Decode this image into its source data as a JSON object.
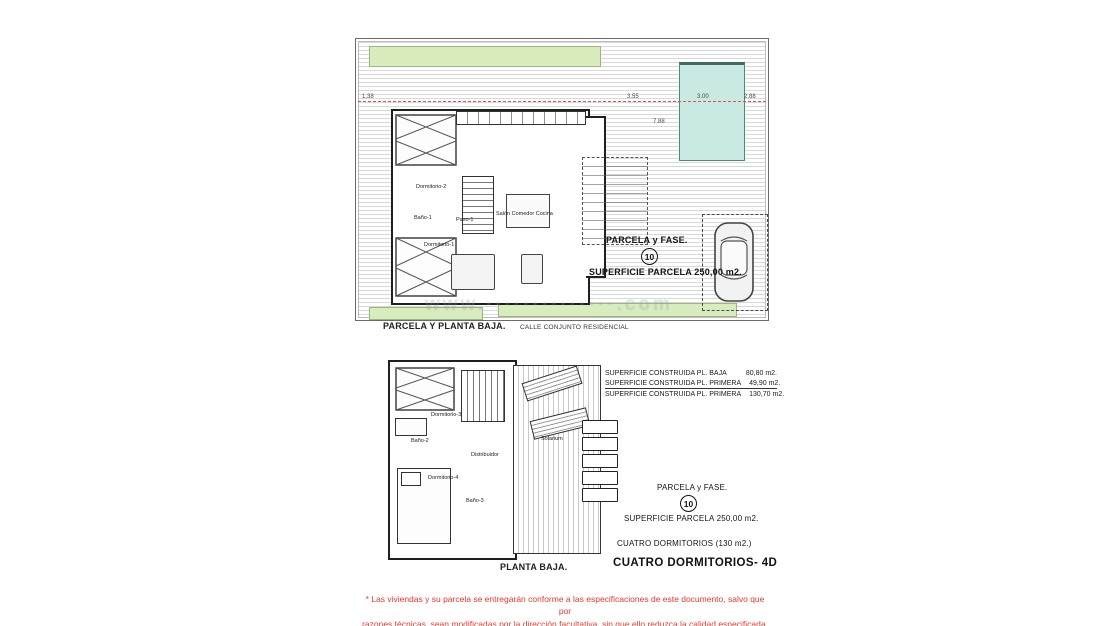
{
  "watermark": "www.··············.com",
  "site_plan": {
    "caption": "PARCELA Y PLANTA BAJA.",
    "street": "CALLE CONJUNTO RESIDENCIAL",
    "parcel_label": "PARCELA y FASE.",
    "parcel_number": "10",
    "parcel_area": "SUPERFICIE PARCELA 250,00 m2.",
    "rooms": {
      "bedroom2": "Dormitorio-2",
      "bath1": "Baño-1",
      "hall": "Paso-1",
      "bedroom1": "Dormitorio-1",
      "living": "Salón Comedor Cocina"
    },
    "dimensions": {
      "left": "1.38",
      "d1": "3.55",
      "d2": "3.00",
      "d3": "2.88",
      "d4": "7.88"
    }
  },
  "floor_plan": {
    "caption": "PLANTA BAJA.",
    "rooms": {
      "bedroom3": "Dormitorio-3",
      "bath2": "Baño-2",
      "hall": "Distribuidor",
      "bedroom4": "Dormitorio-4",
      "bath3": "Baño-3",
      "solarium": "Solarium"
    }
  },
  "summary": {
    "areas": [
      {
        "label": "SUPERFICIE CONSTRUIDA PL. BAJA",
        "value": "80,80 m2."
      },
      {
        "label": "SUPERFICIE CONSTRUIDA PL. PRIMERA",
        "value": "49,90 m2."
      },
      {
        "label": "SUPERFICIE CONSTRUIDA PL. PRIMERA",
        "value": "130,70 m2."
      }
    ],
    "parcel_label": "PARCELA y FASE.",
    "parcel_number": "10",
    "parcel_area": "SUPERFICIE PARCELA 250,00 m2.",
    "bedrooms": "CUATRO DORMITORIOS (130 m2.)",
    "model": "CUATRO DORMITORIOS- 4D"
  },
  "disclaimer": {
    "line1": "* Las viviendas y su parcela se entregarán conforme a las especificaciones de este documento, salvo que por",
    "line2": "razones técnicas, sean modificadas por la dirección facultativa, sin que ello reduzca la calidad especificada."
  },
  "colors": {
    "accent_red": "#e53a2e",
    "grass_green": "#d9ecbe",
    "pool_cyan": "#c9e9e3",
    "setback_red_line": "#e05252"
  }
}
